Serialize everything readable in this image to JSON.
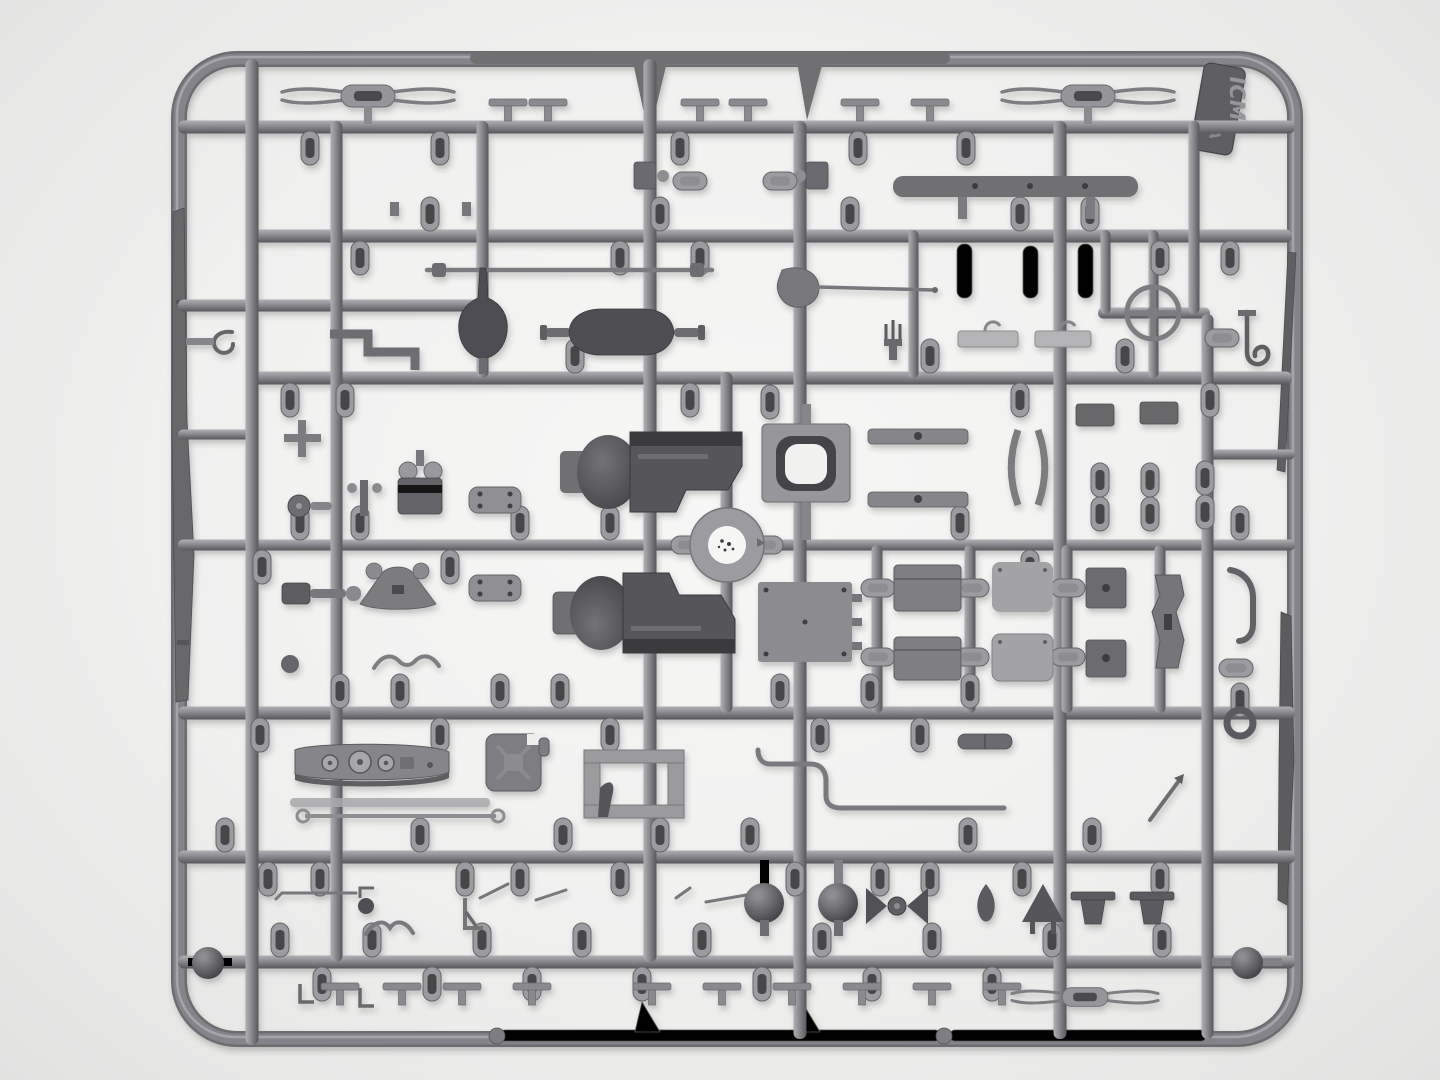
{
  "meta": {
    "title": "Top-down photograph of a gray styrene injection-molded model kit sprue on a white background",
    "brand_tag": {
      "brand": "ICM",
      "sprue_letter": "A"
    }
  },
  "colors": {
    "bg_center": "#f7f7f6",
    "bg_mid": "#f0f0ef",
    "bg_edge": "#e2e2e1",
    "runner_hi": "#b0b0b4",
    "runner_mid": "#8f8f93",
    "runner_lo": "#58585c",
    "frame": "#84848a",
    "part": "#8a8a8e",
    "part_light": "#b4b4b7",
    "part_dark": "#55555a",
    "part_darker": "#3e3e42",
    "sphere_hi": "#8d8d91",
    "sphere_lo": "#313135",
    "label_white": "#f6f6f4",
    "tag_fill": "#5f5f63",
    "tag_emboss": "#95959a"
  },
  "scene": {
    "type": "photograph",
    "subject": "plastic model kit sprue (parts tree) of gray styrene, rounded rectangular runner frame with dense grid of runners and attached parts, soft shadows, monochrome gray palette",
    "center_feature": "round injection hub with white circular ejector label bearing small dark specks",
    "visible_parts": [
      "rounded rectangular sprue frame",
      "ICM brand tag with sprue letter A at top right",
      "grid of horizontal and vertical runners with capsule-shaped gates",
      "two dark transfer-case / axle housings at center",
      "vertical differential housing with pointed finial",
      "horizontal axle shaft with pear-shaped differential bulge",
      "steering wheel with cross spokes (top right)",
      "front bumper bar (top left)",
      "long torsion rod",
      "shovel with long handle",
      "square radiator shell with rounded opening",
      "leaf-spring shackle plates with rivet holes",
      "brake drum with twin caps",
      "instrument dashboard with gauge dials",
      "jerry can with X-embossed faces",
      "H-shaped seat frame",
      "thin tie rod with eye ends",
      "floor panel and tool boxes with seat cushions",
      "contoured chassis bracket",
      "S-bent exhaust pipe and curved sway bars",
      "two large dark spheres and two corner spheres (towing balls)",
      "winged coupling, teardrop and triangle brackets",
      "fork-tipped dumbbell parts (top left, top right, bottom right)",
      "long rifle-like rail along left frame edge",
      "thin blade and rail parts along right frame edge",
      "chassis rails with triangular fins lying along top and bottom frame bars",
      "rows of small T-shaped feet and lever parts"
    ]
  }
}
